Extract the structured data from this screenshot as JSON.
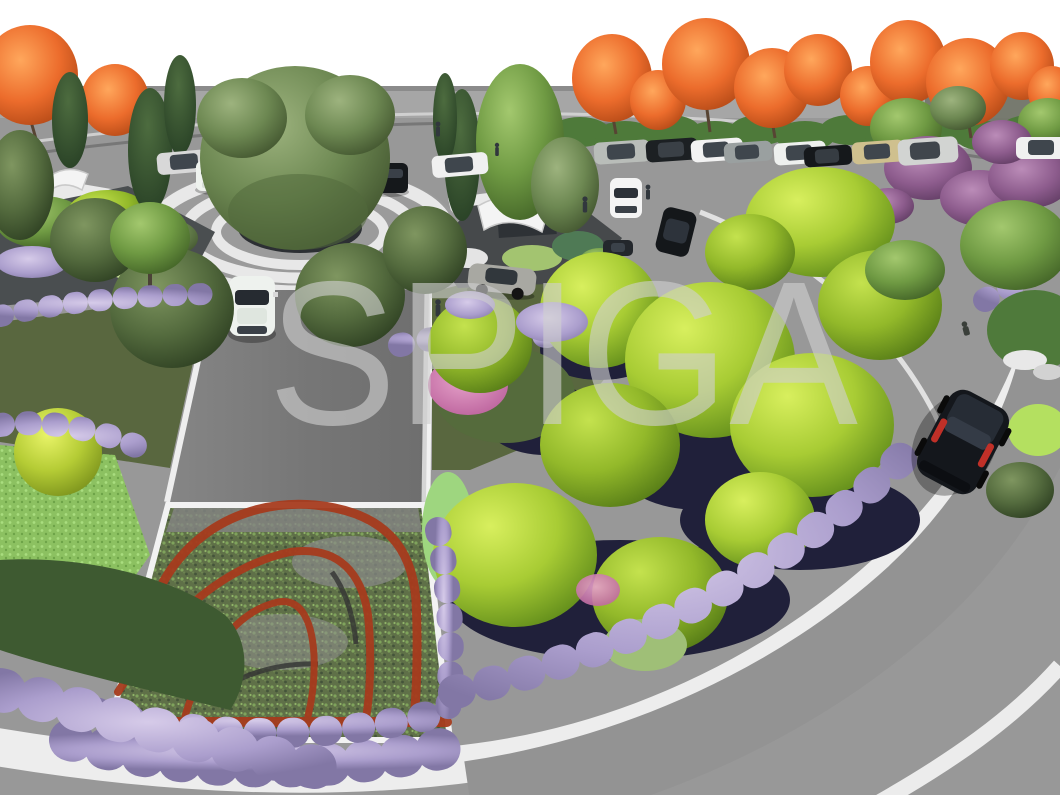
{
  "watermark": {
    "text": "SPIGA",
    "color": "#d0d0d0",
    "opacity": "0.62"
  },
  "scene": {
    "title": "Landscape design 3D rendering - parking entrance with tree roundabout",
    "elements": [
      "white sky",
      "boundary wall",
      "perimeter road",
      "autumn orange trees",
      "purple ornamental trees",
      "parking rows with cars",
      "entry roundabout",
      "specimen tree in circular planter",
      "concentric ring paving",
      "pedestrian crossing spokes",
      "central avenue",
      "white sedan on avenue",
      "silver sedan at junction",
      "planted bed with corten steel curved edging",
      "lavender borders",
      "lime green tree cluster",
      "dark underplanting",
      "curved ring road with sidewalks",
      "black suv on ring road",
      "entry island with shade canopy and boulders",
      "lawn with small tree",
      "yellow green shrub ball",
      "pedestrian figures"
    ],
    "palette": {
      "sky": "#ffffff",
      "road": "#9a9a9a",
      "avenue": "#787878",
      "sidewalk": "#ededed",
      "lawn": "#59673f",
      "lime_tree": "#a8cc34",
      "olive_tree": "#6d8852",
      "conifer": "#2b4227",
      "autumn_orange": "#ec6c2c",
      "ornamental_purple": "#8d5c8d",
      "lavender": "#ab9ecd",
      "corten_red": "#a63b1d",
      "underplanting": "#20203a",
      "suv_black": "#14171c"
    }
  }
}
